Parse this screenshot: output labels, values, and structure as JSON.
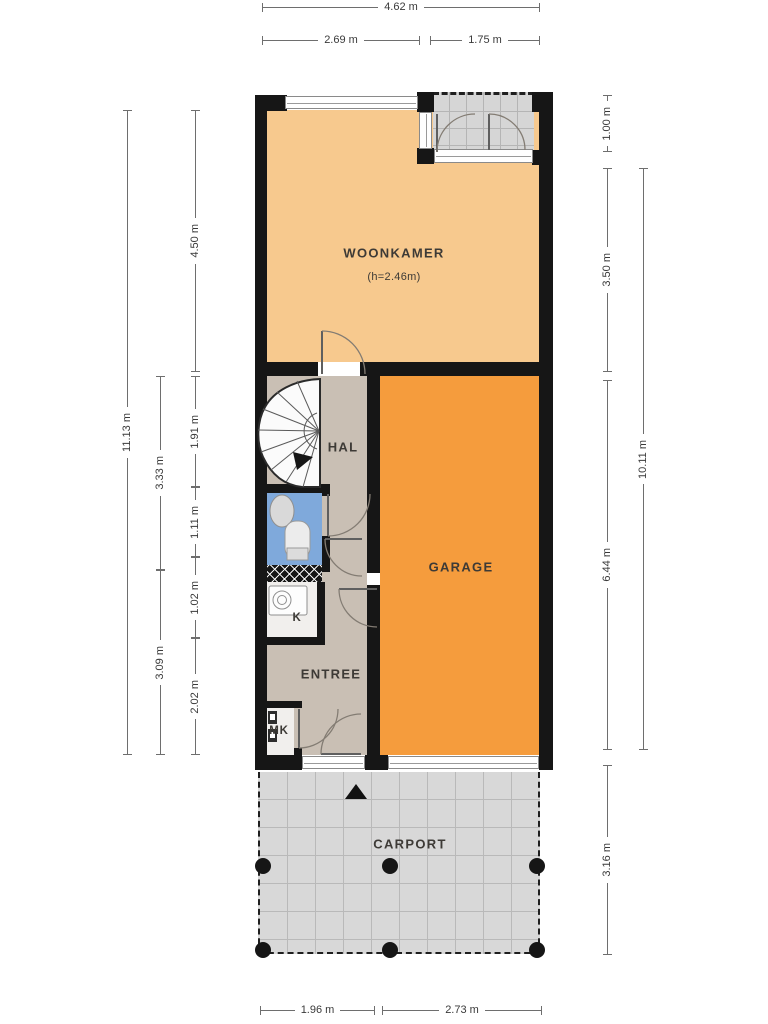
{
  "floorplan": {
    "rooms": {
      "woonkamer": {
        "label": "WOONKAMER",
        "height_note": "(h=2.46m)",
        "floor_color": "#F7C98E"
      },
      "hal": {
        "label": "HAL",
        "floor_color": "#C9BFB4"
      },
      "garage": {
        "label": "GARAGE",
        "floor_color": "#F59C3D"
      },
      "entree": {
        "label": "ENTREE",
        "floor_color": "#C9BFB4"
      },
      "kitchen_closet": {
        "label": "K",
        "floor_color": "#F1EFED"
      },
      "meter_closet": {
        "label": "MK",
        "floor_color": "#F1EFED"
      },
      "toilet": {
        "floor_color": "#7FA9DB"
      },
      "porch": {
        "floor_color": "#D6D6D6"
      },
      "carport": {
        "label": "CARPORT",
        "floor_color": "#D8D8D8"
      }
    },
    "dimensions": {
      "top": [
        "4.62 m",
        "2.69 m",
        "1.75 m"
      ],
      "bottom": [
        "1.96 m",
        "2.73 m"
      ],
      "left_outer": "11.13 m",
      "left_mid": [
        "3.33 m",
        "3.09 m"
      ],
      "left_inner": [
        "4.50 m",
        "1.91 m",
        "1.11 m",
        "1.02 m",
        "2.02 m"
      ],
      "right_inner": [
        "1.00 m",
        "3.50 m",
        "6.44 m",
        "3.16 m"
      ],
      "right_outer": "10.11 m"
    },
    "wall_color": "#161616",
    "icons": [
      "spiral-staircase-icon",
      "north-arrow-icon",
      "toilet-icon",
      "sink-icon",
      "washing-machine-icon",
      "meter-box-icon",
      "carport-post-icon",
      "door-swing-icon",
      "window-icon"
    ]
  }
}
